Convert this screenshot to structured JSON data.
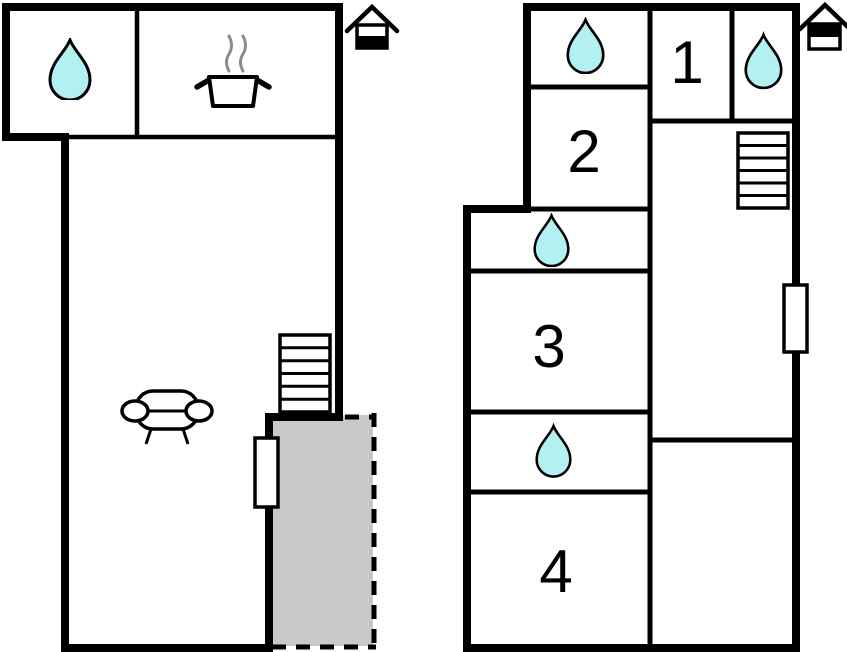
{
  "figure_type": "floor-plan",
  "colors": {
    "wall": "#000000",
    "drop_fill": "#b2f0f2",
    "terrace_fill": "#c9c9c9",
    "steam": "#8c8c8c",
    "background": "#ffffff"
  },
  "ground_floor": {
    "icons": {
      "bathroom": "water-drop",
      "kitchen": "cooking-pot",
      "living_room": "sofa",
      "stairs": "stairs",
      "window": "window",
      "terrace": "dashed-terrace",
      "floor_indicator": "house-lower-half-filled"
    }
  },
  "upper_floor": {
    "rooms": [
      {
        "label": "1"
      },
      {
        "label": "2"
      },
      {
        "label": "3"
      },
      {
        "label": "4"
      }
    ],
    "icons": {
      "bathroom_top": "water-drop",
      "bathroom_right": "water-drop",
      "bathroom_middle": "water-drop",
      "bathroom_lower": "water-drop",
      "stairs": "stairs",
      "window": "window",
      "floor_indicator": "house-upper-half-filled"
    }
  }
}
